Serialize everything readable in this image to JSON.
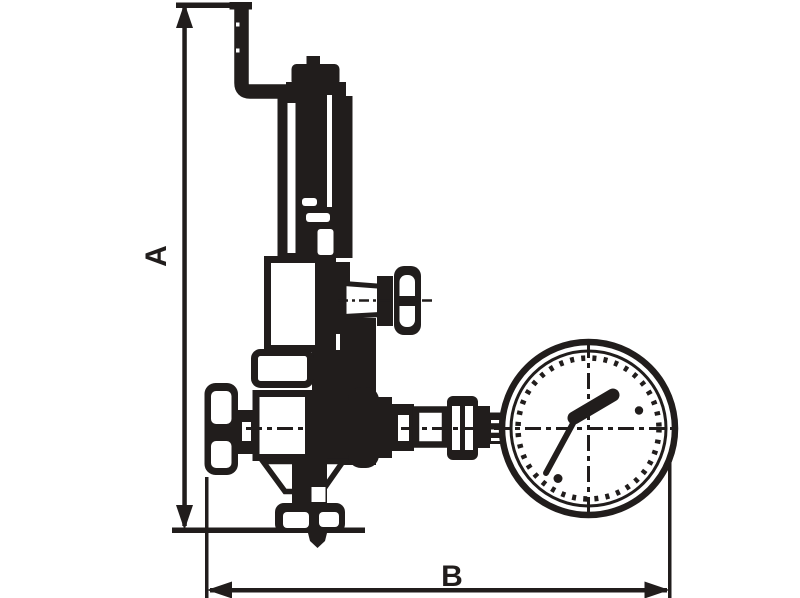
{
  "diagram": {
    "description": "technical-drawing-relief-valve-with-pressure-gauge",
    "labels": {
      "dim_a": "A",
      "dim_b": "B"
    },
    "colors": {
      "ink": "#211d1c",
      "background": "#ffffff"
    }
  }
}
